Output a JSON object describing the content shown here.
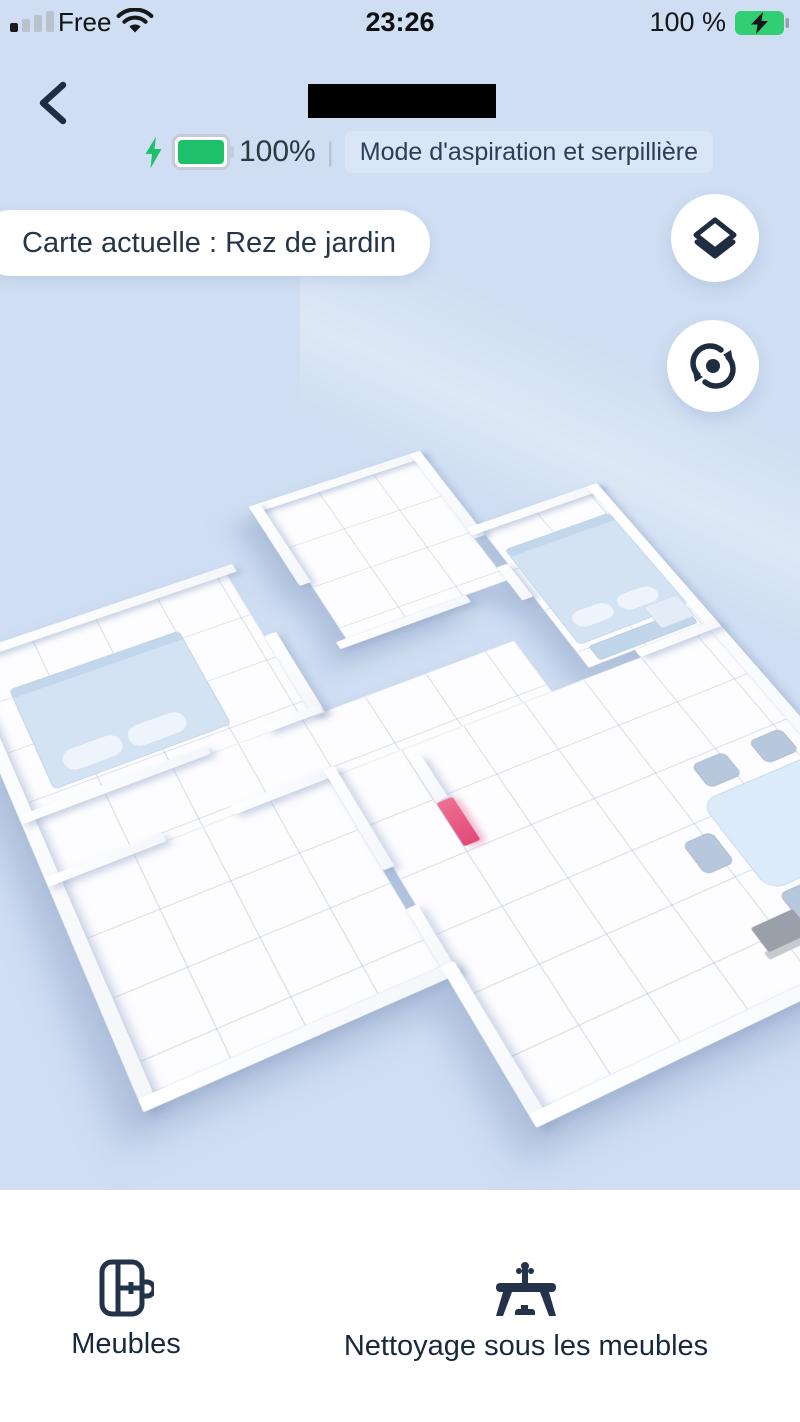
{
  "status_bar": {
    "carrier": "Free",
    "time": "23:26",
    "battery": "100 %"
  },
  "header": {
    "device_battery": "100%",
    "mode_badge": "Mode d'aspiration et serpillière"
  },
  "map": {
    "current_map_label": "Carte actuelle : Rez de jardin"
  },
  "bottom_nav": {
    "furniture": "Meubles",
    "clean_under_furniture": "Nettoyage sous les meubles"
  },
  "colors": {
    "background": "#cfdef2",
    "accent_green": "#1fc06a",
    "badge_bg": "#dbe5f8",
    "navy": "#1e2d42",
    "robot_pink": "#e85583",
    "bed_blue": "#d3e3f4",
    "table_blue": "#dcebfa"
  }
}
